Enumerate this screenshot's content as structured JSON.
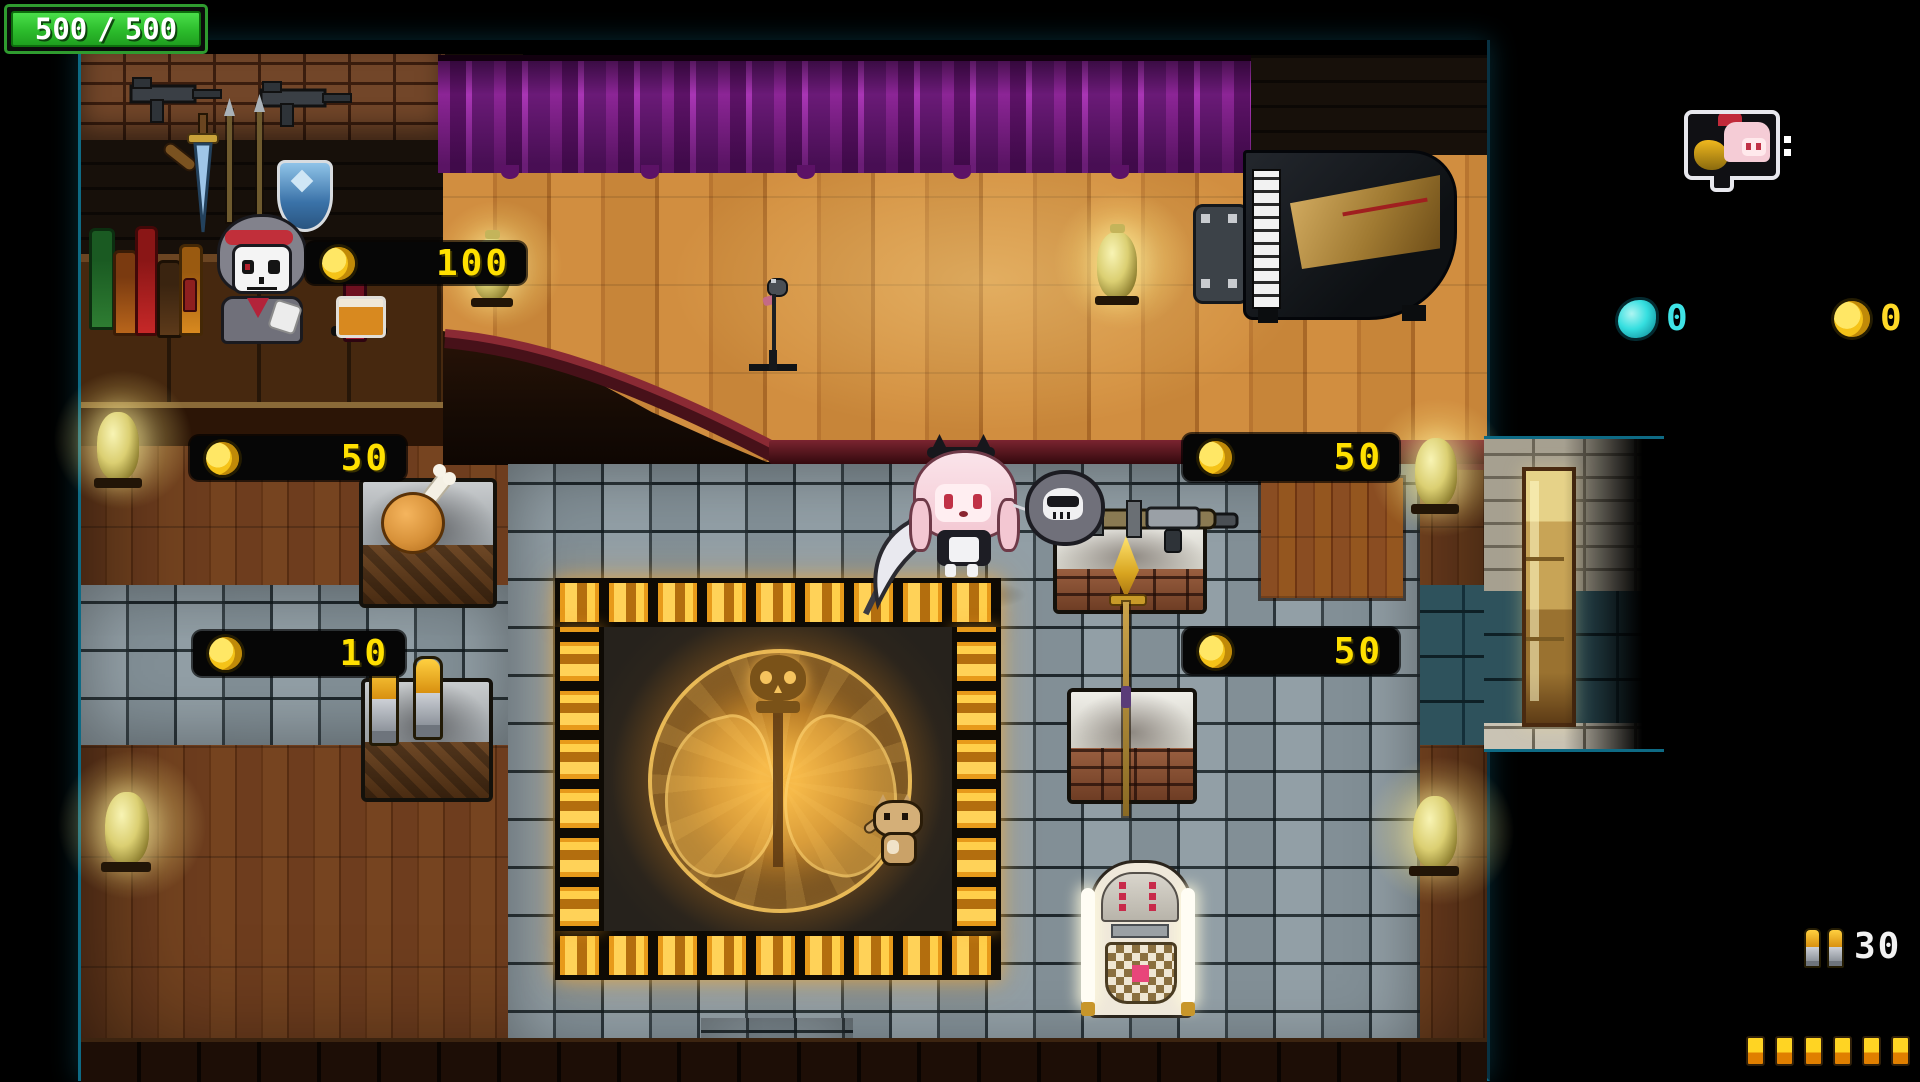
{
  "hud": {
    "health": {
      "current": "500",
      "separator": "/",
      "max": "500"
    },
    "partner": {
      "icon": "partner-portrait-bubble"
    },
    "gem_counter": {
      "icon": "soul-gem-icon",
      "value": "0"
    },
    "coin_counter": {
      "icon": "gold-coin-icon",
      "value": "0"
    },
    "ammo_counter": {
      "icon": "rifle-bullets-icon",
      "value": "30"
    },
    "ammo_reserve": {
      "icon": "ammo-pip",
      "count": 6
    }
  },
  "shop": {
    "price_tags": [
      {
        "item": "bar-drink",
        "value": "100"
      },
      {
        "item": "roast-chicken",
        "value": "50"
      },
      {
        "item": "ammo-pack",
        "value": "10"
      },
      {
        "item": "rocket-launcher",
        "value": "50"
      },
      {
        "item": "golden-spear",
        "value": "50"
      }
    ]
  },
  "colors": {
    "price_text": "#ffe000",
    "coin_gold": "#ffd927",
    "gem_teal": "#3fe3e6",
    "health_green": "#2ecc2e",
    "curtain_purple": "#8c2596",
    "rune_gold": "#f5a623"
  }
}
